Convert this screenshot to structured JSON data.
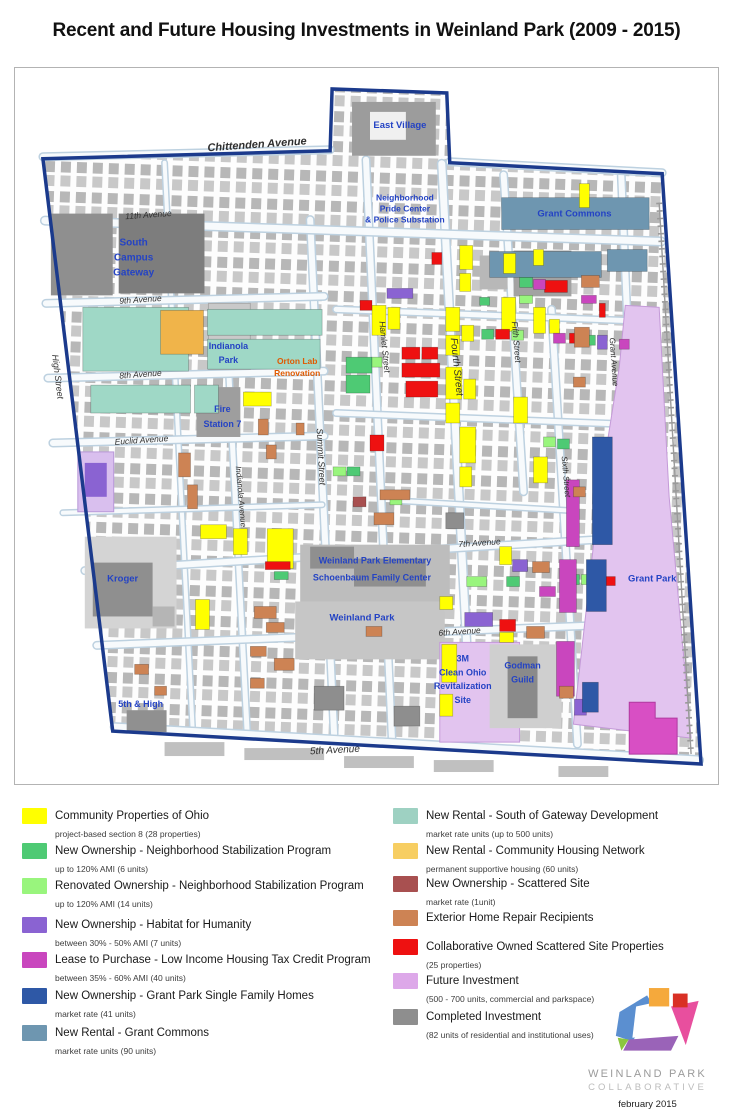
{
  "title": "Recent and Future Housing Investments in Weinland Park (2009 - 2015)",
  "map": {
    "palette": {
      "yellow": "#ffff00",
      "green": "#4eca74",
      "light_green": "#99f57d",
      "purple": "#8a63d2",
      "magenta": "#c946be",
      "dark_blue": "#2e58a6",
      "steel_blue": "#6e96b0",
      "teal": "#9fd8c6",
      "chn_orange": "#f0b44a",
      "maroon": "#a85050",
      "repair_orange": "#cd8354",
      "red": "#ee1111",
      "future_violet": "#e2c4ef",
      "future_magenta": "#d84fc4",
      "completed_gray": "#8e8e8e",
      "boundary_blue": "#1b3a8c",
      "label_blue": "#2443c4",
      "orton_orange": "#e05a00"
    },
    "streets": {
      "chittenden": "Chittenden Avenue",
      "eleventh": "11th Avenue",
      "ninth": "9th Avenue",
      "eighth": "8th Avenue",
      "euclid": "Euclid Avenue",
      "seventh": "7th Avenue",
      "sixth_ave": "6th Avenue",
      "fifth_ave": "5th Avenue",
      "high": "High Street",
      "summit": "Summit Street",
      "indianola": "Indianola Avenue",
      "hamlet": "Hamlet Street",
      "fourth": "Fourth Street",
      "fifth_st": "Fifth Street",
      "sixth_st": "Sixth Street",
      "grant": "Grant Avenue"
    },
    "places": {
      "east_village": "East Village",
      "pride1": "Neighborhood",
      "pride2": "Pride Center",
      "pride3": "& Police Substation",
      "grant_commons": "Grant Commons",
      "scg1": "South",
      "scg2": "Campus",
      "scg3": "Gateway",
      "indianola_park1": "Indianola",
      "indianola_park2": "Park",
      "orton1": "Orton Lab",
      "orton2": "Renovation",
      "fire1": "Fire",
      "fire2": "Station 7",
      "wpe": "Weinland Park Elementary",
      "sfc": "Schoenbaum Family Center",
      "weinland_park": "Weinland Park",
      "kroger": "Kroger",
      "grant_park": "Grant Park",
      "m3_1": "3M",
      "m3_2": "Clean Ohio",
      "m3_3": "Revitalization",
      "m3_4": "Site",
      "godman1": "Godman",
      "godman2": "Guild",
      "fifth_high": "5th & High"
    }
  },
  "legend": {
    "left": [
      {
        "label": "Community Properties of Ohio",
        "sublabel": "project-based section 8 (28 properties)",
        "color": "#ffff00"
      },
      {
        "label": "New Ownership - Neighborhood Stabilization Program",
        "sublabel": "up to 120% AMI (6 units)",
        "color": "#4eca74"
      },
      {
        "label": "Renovated Ownership - Neighborhood Stabilization Program",
        "sublabel": "up to 120% AMI (14 units)",
        "color": "#99f57d"
      },
      {
        "label": "New Ownership - Habitat for Humanity",
        "sublabel": "between 30% - 50% AMI (7 units)",
        "color": "#8a63d2"
      },
      {
        "label": "Lease to Purchase - Low Income Housing Tax Credit Program",
        "sublabel": "between 35% - 60% AMI (40 units)",
        "color": "#c946be"
      },
      {
        "label": "New Ownership - Grant Park Single Family Homes",
        "sublabel": "market rate (41 units)",
        "color": "#2e58a6"
      },
      {
        "label": "New Rental - Grant Commons",
        "sublabel": "market rate units (90 units)",
        "color": "#6e96b0"
      }
    ],
    "right": [
      {
        "label": "New Rental - South of Gateway Development",
        "sublabel": "market rate units (up to 500 units)",
        "color": "#9ed1c2"
      },
      {
        "label": "New Rental - Community Housing Network",
        "sublabel": "permanent supportive housing (60 units)",
        "color": "#f7ce62"
      },
      {
        "label": "New Ownership - Scattered Site",
        "sublabel": "market rate (1unit)",
        "color": "#a85050"
      },
      {
        "label": "Exterior Home Repair Recipients",
        "sublabel": "",
        "color": "#cd8354"
      },
      {
        "label": "Collaborative Owned Scattered Site Properties",
        "sublabel": "(25 properties)",
        "color": "#ee1111"
      },
      {
        "label": "Future Investment",
        "sublabel": "(500 - 700 units, commercial and parkspace)",
        "color": "#dda8e9"
      },
      {
        "label": "Completed Investment",
        "sublabel": "(82 units of residential and institutional uses)",
        "color": "#8e8e8e"
      }
    ]
  },
  "footer": {
    "org_line1": "WEINLAND PARK",
    "org_line2": "COLLABORATIVE",
    "date": "february 2015"
  }
}
